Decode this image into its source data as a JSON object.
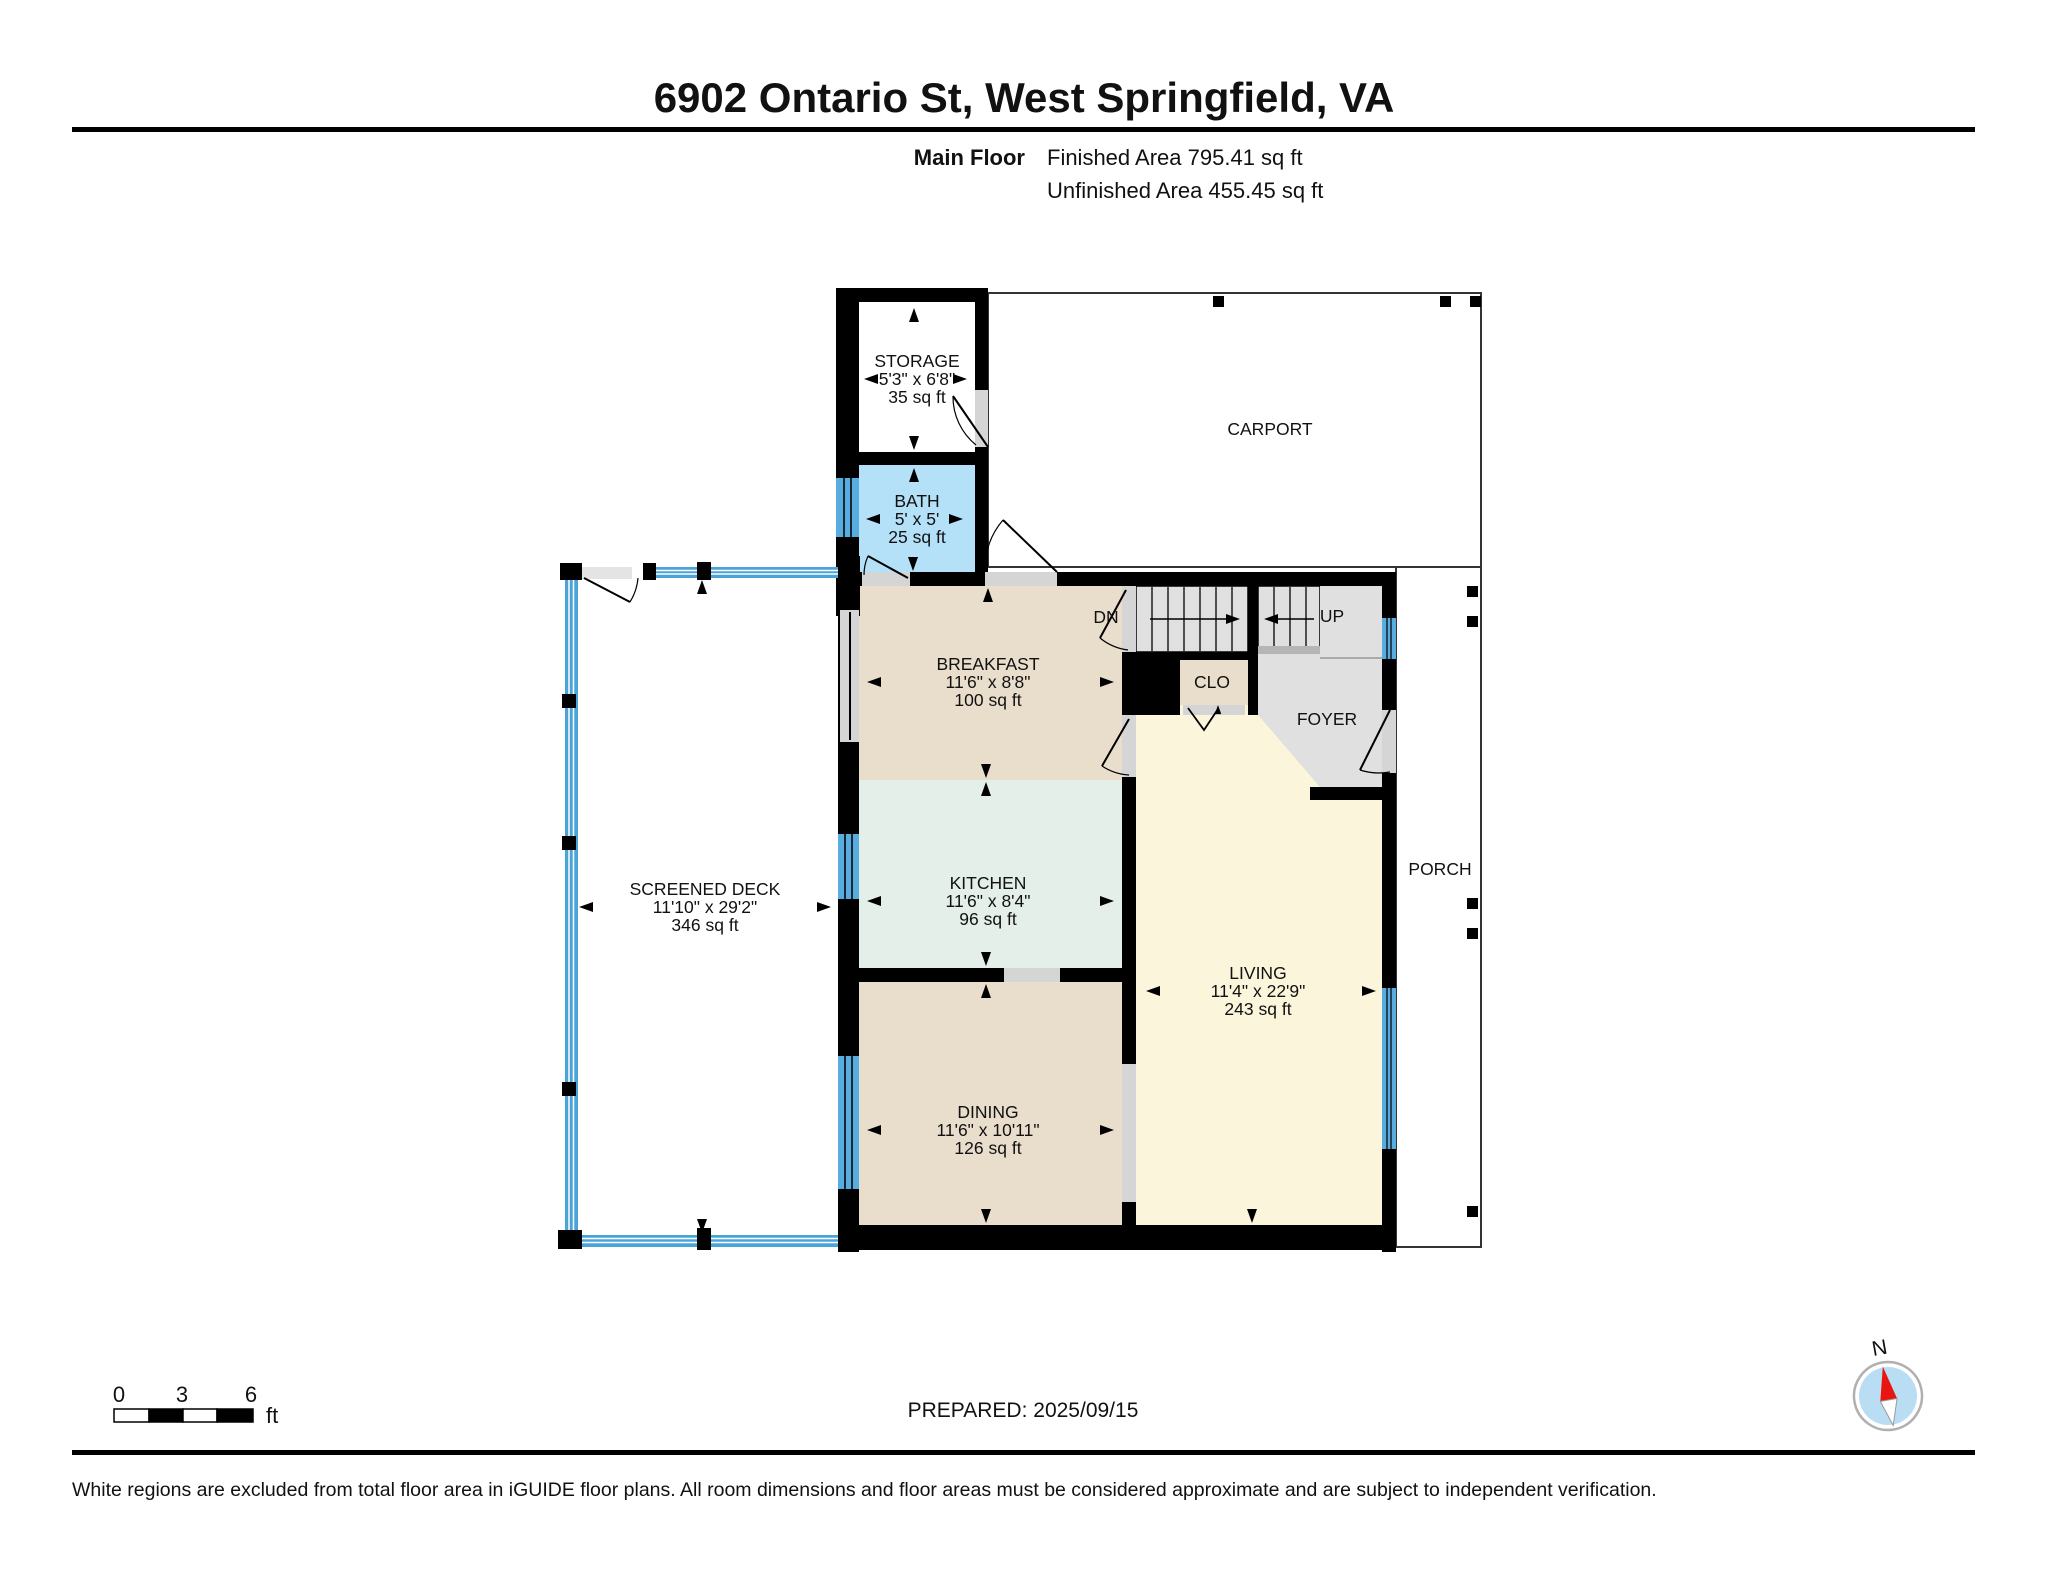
{
  "header": {
    "title": "6902 Ontario St, West Springfield, VA",
    "floor_label": "Main Floor",
    "finished_area": "Finished Area 795.41 sq ft",
    "unfinished_area": "Unfinished Area 455.45 sq ft"
  },
  "rooms": {
    "storage": {
      "name": "STORAGE",
      "dims": "5'3\" x 6'8\"",
      "area": "35 sq ft"
    },
    "bath": {
      "name": "BATH",
      "dims": "5' x 5'",
      "area": "25 sq ft"
    },
    "carport": {
      "name": "CARPORT"
    },
    "breakfast": {
      "name": "BREAKFAST",
      "dims": "11'6\" x 8'8\"",
      "area": "100 sq ft"
    },
    "kitchen": {
      "name": "KITCHEN",
      "dims": "11'6\" x 8'4\"",
      "area": "96 sq ft"
    },
    "dining": {
      "name": "DINING",
      "dims": "11'6\" x 10'11\"",
      "area": "126 sq ft"
    },
    "living": {
      "name": "LIVING",
      "dims": "11'4\" x 22'9\"",
      "area": "243 sq ft"
    },
    "screened_deck": {
      "name": "SCREENED DECK",
      "dims": "11'10\" x 29'2\"",
      "area": "346 sq ft"
    },
    "foyer": {
      "name": "FOYER"
    },
    "porch": {
      "name": "PORCH"
    },
    "closet": {
      "name": "CLO"
    },
    "stair_down": {
      "name": "DN"
    },
    "stair_up": {
      "name": "UP"
    }
  },
  "scale_bar": {
    "ticks": [
      "0",
      "3",
      "6"
    ],
    "unit": "ft"
  },
  "compass": {
    "north_label": "N"
  },
  "footer": {
    "prepared": "PREPARED: 2025/09/15",
    "disclaimer": "White regions are excluded from total floor area in iGUIDE floor plans. All room dimensions and floor areas must be considered approximate and are subject to independent verification."
  },
  "colors": {
    "wall": "#000000",
    "tan_floor": "#e9ddcc",
    "kitchen_green": "#e3efe8",
    "living_cream": "#fbf5dc",
    "bath_blue": "#b5e1f8",
    "window_blue": "#58ade0",
    "screen_blue": "#4ba4d9",
    "floor_gray": "#e0e0e0",
    "opening_gray": "#d5d5d5",
    "compass_red": "#e81510",
    "compass_blue": "#b9ddf3"
  }
}
